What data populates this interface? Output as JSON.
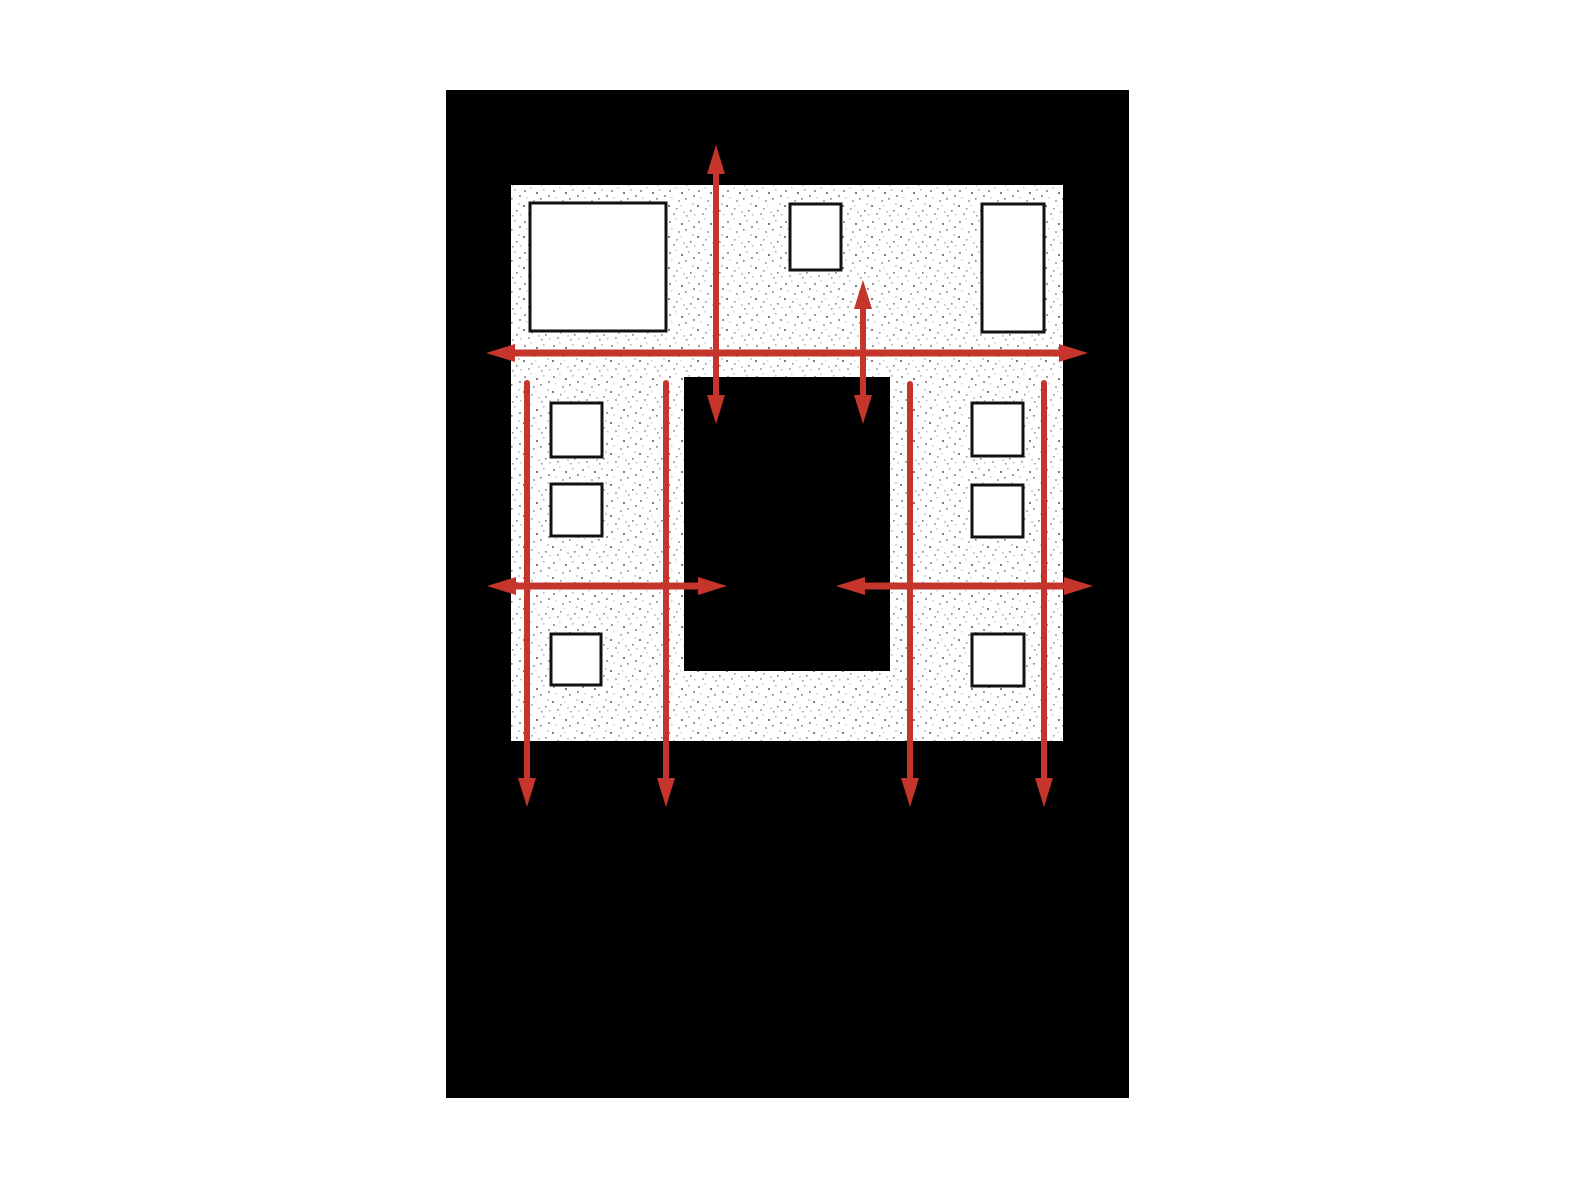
{
  "page": {
    "width": 1572,
    "height": 1182,
    "background": "#ffffff"
  },
  "board": {
    "x": 446,
    "y": 90,
    "width": 683,
    "height": 1008,
    "fill": "#000000"
  },
  "palette": {
    "arrow_red": "#c5352c",
    "wall_fill": "#ffffff",
    "stipple_dots": [
      "#7e7e7e",
      "#9b9b9b",
      "#b5b5b5",
      "#d2d2d2"
    ],
    "window_fill": "#ffffff",
    "window_stroke": "#111111",
    "board_black": "#000000",
    "page_white": "#ffffff"
  },
  "building": {
    "outer": {
      "x": 511,
      "y": 185,
      "width": 552,
      "height": 556
    },
    "opening": {
      "x": 684,
      "y": 377,
      "width": 206,
      "height": 294
    }
  },
  "window_stroke_width": 3,
  "windows": [
    {
      "name": "window-upper-left-large",
      "x": 530,
      "y": 203,
      "width": 136,
      "height": 128
    },
    {
      "name": "window-upper-middle",
      "x": 790,
      "y": 204,
      "width": 51,
      "height": 66
    },
    {
      "name": "window-upper-right",
      "x": 982,
      "y": 204,
      "width": 62,
      "height": 128
    },
    {
      "name": "window-left-pier-top",
      "x": 551,
      "y": 403,
      "width": 51,
      "height": 54
    },
    {
      "name": "window-left-pier-middle",
      "x": 551,
      "y": 484,
      "width": 51,
      "height": 52
    },
    {
      "name": "window-left-pier-bottom",
      "x": 551,
      "y": 634,
      "width": 50,
      "height": 51
    },
    {
      "name": "window-right-pier-top",
      "x": 972,
      "y": 403,
      "width": 51,
      "height": 53
    },
    {
      "name": "window-right-pier-middle",
      "x": 972,
      "y": 485,
      "width": 51,
      "height": 52
    },
    {
      "name": "window-right-pier-bottom",
      "x": 972,
      "y": 634,
      "width": 52,
      "height": 52
    }
  ],
  "arrow_head": {
    "length": 29,
    "half_width": 9
  },
  "arrows": [
    {
      "name": "uplift-arrow-left",
      "x1": 716,
      "y1": 424,
      "x2": 716,
      "y2": 145,
      "width": 6,
      "heads": "both"
    },
    {
      "name": "uplift-arrow-right",
      "x1": 863,
      "y1": 424,
      "x2": 863,
      "y2": 280,
      "width": 6,
      "heads": "both"
    },
    {
      "name": "upper-story-shear-arrow",
      "x1": 486,
      "y1": 353,
      "x2": 1088,
      "y2": 353,
      "width": 7,
      "heads": "both"
    },
    {
      "name": "lower-left-shear-arrow",
      "x1": 487,
      "y1": 586,
      "x2": 727,
      "y2": 586,
      "width": 7,
      "heads": "both"
    },
    {
      "name": "lower-right-shear-arrow",
      "x1": 1093,
      "y1": 586,
      "x2": 836,
      "y2": 586,
      "width": 7,
      "heads": "both"
    },
    {
      "name": "holddown-arrow-far-left",
      "x1": 527,
      "y1": 383,
      "x2": 527,
      "y2": 807,
      "width": 6,
      "heads": "end"
    },
    {
      "name": "holddown-arrow-inner-left",
      "x1": 666,
      "y1": 383,
      "x2": 666,
      "y2": 807,
      "width": 6,
      "heads": "end"
    },
    {
      "name": "holddown-arrow-inner-right",
      "x1": 910,
      "y1": 384,
      "x2": 910,
      "y2": 807,
      "width": 6,
      "heads": "end"
    },
    {
      "name": "holddown-arrow-far-right",
      "x1": 1044,
      "y1": 383,
      "x2": 1044,
      "y2": 807,
      "width": 6,
      "heads": "end"
    }
  ]
}
